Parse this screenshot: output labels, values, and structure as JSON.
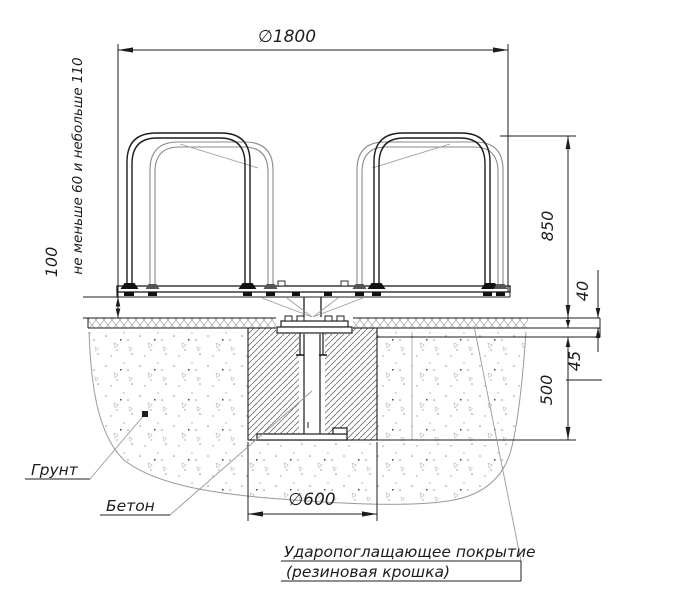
{
  "drawing": {
    "dimensions": {
      "platform_diameter": "∅1800",
      "clearance_note": "не меньше 60 и небольше 110",
      "platform_clearance": "100",
      "handrail_height": "850",
      "coating_thickness": "40",
      "base_layer_thickness": "45",
      "foundation_depth": "500",
      "foundation_diameter": "∅600"
    },
    "labels": {
      "soil": "Грунт",
      "concrete": "Бетон",
      "coating_line1": "Ударопоглащающее покрытие",
      "coating_line2": "(резиновая крошка)"
    },
    "colors": {
      "line": "#1c1c1c",
      "aux": "#8f8f8f"
    }
  }
}
